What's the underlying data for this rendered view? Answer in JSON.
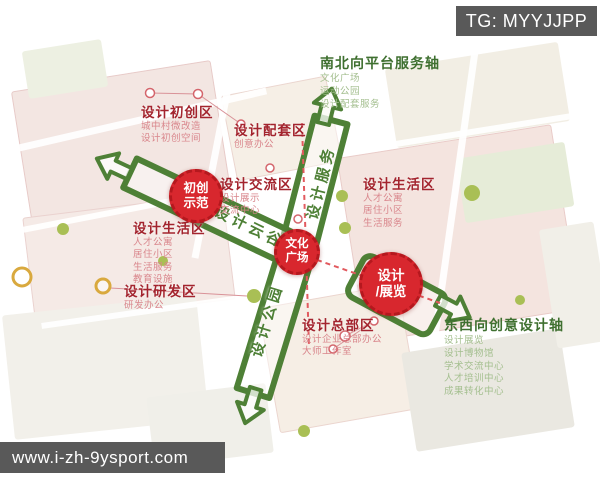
{
  "overlays": {
    "telegram_tag": "TG: MYYJJPP",
    "website": "www.i-zh-9ysport.com"
  },
  "axes": {
    "north_south": {
      "title": "南北向平台服务轴",
      "items": [
        "文化广场",
        "运动公园",
        "设计配套服务"
      ]
    },
    "east_west": {
      "title": "东西向创意设计轴",
      "items": [
        "设计展览",
        "设计博物馆",
        "学术交流中心",
        "人才培训中心",
        "成果转化中心"
      ]
    }
  },
  "corridors": {
    "service": "设计服务",
    "valley": "设计云谷",
    "park": "设计公园"
  },
  "nodes": {
    "startup": [
      "初创",
      "示范"
    ],
    "culture": [
      "文化",
      "广场"
    ],
    "exhibition": [
      "设计",
      "/展览"
    ]
  },
  "zones": [
    {
      "id": "startup-zone",
      "title": "设计初创区",
      "items": [
        "城中村微改造",
        "设计初创空间"
      ]
    },
    {
      "id": "support-zone",
      "title": "设计配套区",
      "items": [
        "创意办公"
      ]
    },
    {
      "id": "exchange-zone",
      "title": "设计交流区",
      "items": [
        "设计展示",
        "交流中心"
      ]
    },
    {
      "id": "living-zone-west",
      "title": "设计生活区",
      "items": [
        "人才公寓",
        "居住小区",
        "生活服务",
        "教育设施"
      ]
    },
    {
      "id": "rnd-zone",
      "title": "设计研发区",
      "items": [
        "研发办公"
      ]
    },
    {
      "id": "living-zone-east",
      "title": "设计生活区",
      "items": [
        "人才公寓",
        "居住小区",
        "生活服务"
      ]
    },
    {
      "id": "headquarters-zone",
      "title": "设计总部区",
      "items": [
        "设计企业总部办公",
        "大师工作室"
      ]
    }
  ],
  "colors": {
    "corridor_green": "#4e8036",
    "axis_green": "#3f7030",
    "badge_red": "#d8272e",
    "zone_title_red": "#a3242e",
    "zone_item_pink": "#d9868c",
    "watermark_bg": "#595959"
  }
}
